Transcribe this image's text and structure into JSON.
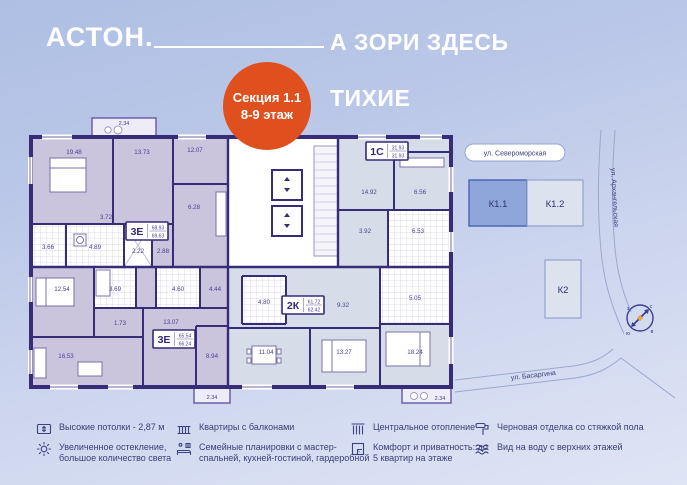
{
  "header": {
    "logo": "АСТОН.",
    "title_line1": "А ЗОРИ ЗДЕСЬ",
    "title_line2": "ТИХИЕ"
  },
  "badge": {
    "line1": "Секция 1.1",
    "line2": "8-9 этаж"
  },
  "plan": {
    "apartments": {
      "tl": {
        "type": "3Е",
        "area_living": "68.93",
        "area_total": "69.63",
        "balcony": "2.34",
        "rooms": [
          "19.48",
          "13.73",
          "12.07",
          "6.28",
          "3.72",
          "3.66",
          "4.89",
          "2.22",
          "2.88"
        ]
      },
      "bl": {
        "type": "3Е",
        "area_living": "65.54",
        "area_total": "66.24",
        "balcony": "2.34",
        "rooms": [
          "12.54",
          "3.69",
          "4.60",
          "4.44",
          "1.73",
          "13.07",
          "16.53",
          "8.94"
        ]
      },
      "k2": {
        "type": "2К",
        "area_living": "61.72",
        "area_total": "62.42",
        "balcony": "2.34",
        "rooms": [
          "4.80",
          "9.32",
          "11.04",
          "13.27",
          "18.24",
          "5.05"
        ]
      },
      "s1": {
        "type": "1С",
        "area_living": "31.93",
        "area_total": "31.93",
        "rooms": [
          "14.92",
          "6.56",
          "3.92",
          "6.53"
        ]
      }
    }
  },
  "map": {
    "streets": {
      "north": "ул. Североморская",
      "east": "ул. Архангельская",
      "south": "ул. Басаргина"
    },
    "buildings": [
      {
        "label": "К1.1",
        "selected": true
      },
      {
        "label": "К1.2",
        "selected": false
      },
      {
        "label": "К2",
        "selected": false
      }
    ],
    "compass": {
      "n": "с",
      "e": "в",
      "s": "ю",
      "w": "з"
    }
  },
  "legend": {
    "items": [
      {
        "icon": "ceiling-height-icon",
        "text": "Высокие потолки - 2,87 м"
      },
      {
        "icon": "sun-icon",
        "text": "Увеличенное остекление, большое количество света"
      },
      {
        "icon": "balcony-icon",
        "text": "Квартиры с балконами"
      },
      {
        "icon": "family-layout-icon",
        "text": "Семейные планировки с мастер-спальней, кухней-гостиной, гардеробной"
      },
      {
        "icon": "radiator-icon",
        "text": "Центральное отопление"
      },
      {
        "icon": "privacy-icon",
        "text": "Комфорт и приватность: до 5 квартир на этаже"
      },
      {
        "icon": "paint-roller-icon",
        "text": "Черновая отделка со стяжкой пола"
      },
      {
        "icon": "water-view-icon",
        "text": "Вид на воду с верхних этажей"
      }
    ]
  },
  "colors": {
    "accent_orange": "#e0501e",
    "wall": "#372c78",
    "apartment_purple": "#cbc4dd",
    "apartment_blue": "#d7dde8",
    "selected_building": "#8ea6da",
    "text_navy": "#3a4077"
  }
}
